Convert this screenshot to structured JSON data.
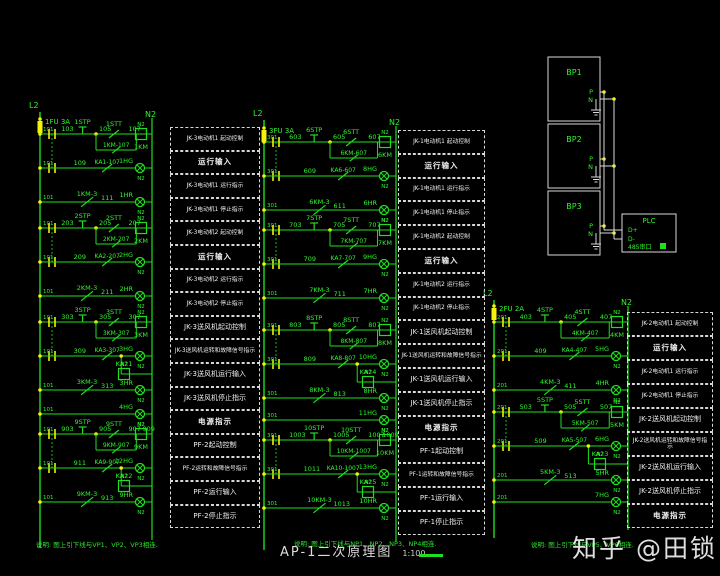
{
  "watermark": {
    "text": "知乎 @田锁"
  },
  "title_block": {
    "title": "AP-1二次原理图",
    "scale": "1:100"
  },
  "notes": {
    "left": "说明: 图上引下线与VP1、VP2、VP3相连.",
    "center": "说明: 图上引下线与NP1、NP2、NP3、NP4相连.",
    "right": "说明: 图上引下线与VP5、VP6相连."
  },
  "colors": {
    "wire": "#1fdf1f",
    "text": "#2ef52e",
    "accent": "#f2f20a",
    "panel": "#d9d9d9"
  },
  "bp_panel": {
    "units": [
      "BP1",
      "BP2",
      "BP3"
    ],
    "terminal_p": "P",
    "terminal_n": "N",
    "plc": {
      "title": "PLC",
      "d_plus": "D+",
      "d_minus": "D-",
      "port": "485串口"
    }
  },
  "columns": [
    {
      "phase": "L2",
      "neutral": "N2",
      "fuse": "1FU 3A",
      "rail_tag": "101",
      "power_lamp": "4HG",
      "sections": [
        {
          "nums": [
            "103",
            "105",
            "107"
          ],
          "stp": "1STP",
          "stt": "1STT",
          "coil": "1KM",
          "seal": "1KM-107",
          "ka_num": "109",
          "ka": "KA1-107",
          "hg": "1HG",
          "run": "1KM-3",
          "run_num": "111",
          "hr": "1HR"
        },
        {
          "nums": [
            "203",
            "205",
            "207"
          ],
          "stp": "2STP",
          "stt": "2STT",
          "coil": "2KM",
          "seal": "2KM-207",
          "ka_num": "209",
          "ka": "KA2-207",
          "hg": "2HG",
          "run": "2KM-3",
          "run_num": "211",
          "hr": "2HR"
        },
        {
          "nums": [
            "303",
            "305",
            "307"
          ],
          "stp": "3STP",
          "stt": "3STT",
          "coil": "3KM",
          "seal": "3KM-307",
          "ka_num": "309",
          "ka": "KA3-307",
          "hg": "3HG",
          "aux": "KA21",
          "run": "3KM-3",
          "run_num": "313",
          "hr": "3HR"
        },
        {
          "nums": [
            "903",
            "905",
            "907"
          ],
          "num4": "909",
          "stp": "9STP",
          "stt": "9STT",
          "coil": "9KM",
          "seal": "9KM-907",
          "ka_num": "911",
          "ka": "KA9-907",
          "hg": "12HG",
          "aux": "KA22",
          "run": "9KM-3",
          "run_num": "913",
          "hr": "9HR"
        }
      ],
      "boxes": [
        "JK-3电动机1 起动控制",
        "运行输入",
        "JK-3电动机1 运行指示",
        "JK-3电动机1 停止指示",
        "JK-3电动机2 起动控制",
        "运行输入",
        "JK-3电动机2 运行指示",
        "JK-3电动机2 停止指示",
        "JK-3送风机起动控制",
        "JK-3送风机运转和故障信号指示",
        "JK-3送风机运行输入",
        "JK-3送风机停止指示",
        "电源指示",
        "PF-2起动控制",
        "PF-2运转和故障信号指示",
        "PF-2运行输入",
        "PF-2停止指示"
      ]
    },
    {
      "phase": "L2",
      "neutral": "N2",
      "fuse": "3FU 3A",
      "rail_tag": "301",
      "power_lamp": "11HG",
      "sections": [
        {
          "nums": [
            "603",
            "605",
            "607"
          ],
          "stp": "6STP",
          "stt": "6STT",
          "coil": "6KM",
          "seal": "6KM-607",
          "ka_num": "609",
          "ka": "KA6-607",
          "hg": "8HG",
          "run": "6KM-3",
          "run_num": "611",
          "hr": "6HR"
        },
        {
          "nums": [
            "703",
            "705",
            "707"
          ],
          "stp": "7STP",
          "stt": "7STT",
          "coil": "7KM",
          "seal": "7KM-707",
          "ka_num": "709",
          "ka": "KA7-707",
          "hg": "9HG",
          "run": "7KM-3",
          "run_num": "711",
          "hr": "7HR"
        },
        {
          "nums": [
            "803",
            "805",
            "807"
          ],
          "stp": "8STP",
          "stt": "8STT",
          "coil": "8KM",
          "seal": "8KM-807",
          "ka_num": "809",
          "ka": "KA8-807",
          "hg": "10HG",
          "aux": "KA24",
          "run": "8KM-3",
          "run_num": "813",
          "hr": "8HR"
        },
        {
          "nums": [
            "1003",
            "1005",
            "1007"
          ],
          "num4": "1009",
          "stp": "10STP",
          "stt": "10STT",
          "coil": "10KM",
          "seal": "10KM-1007",
          "ka_num": "1011",
          "ka": "KA10-1007",
          "hg": "13HG",
          "aux": "KA25",
          "run": "10KM-3",
          "run_num": "1013",
          "hr": "10HR"
        }
      ],
      "boxes": [
        "JK-1电动机1 起动控制",
        "运行输入",
        "JK-1电动机1 运行指示",
        "JK-1电动机1 停止指示",
        "JK-1电动机2 起动控制",
        "运行输入",
        "JK-1电动机2 运行指示",
        "JK-1电动机2 停止指示",
        "JK-1送风机起动控制",
        "JK-1送风机运转和故障信号指示",
        "JK-1送风机运行输入",
        "JK-1送风机停止指示",
        "电源指示",
        "PF-1起动控制",
        "PF-1运转和故障信号指示",
        "PF-1运行输入",
        "PF-1停止指示"
      ]
    },
    {
      "phase": "L2",
      "neutral": "N2",
      "fuse": "2FU 2A",
      "rail_tag": "201",
      "power_lamp": "7HG",
      "sections": [
        {
          "nums": [
            "403",
            "405",
            "407"
          ],
          "stp": "4STP",
          "stt": "4STT",
          "coil": "4KM",
          "seal": "4KM-407",
          "ka_num": "409",
          "ka": "KA4-407",
          "hg": "5HG",
          "run": "4KM-3",
          "run_num": "411",
          "hr": "4HR"
        },
        {
          "nums": [
            "503",
            "505",
            "507"
          ],
          "stp": "5STP",
          "stt": "5STT",
          "coil": "5KM",
          "seal": "5KM-507",
          "ka_num": "509",
          "ka": "KA5-507",
          "hg": "6HG",
          "aux": "KA23",
          "run": "5KM-3",
          "run_num": "513",
          "hr": "5HR"
        }
      ],
      "boxes": [
        "JK-2电动机1 起动控制",
        "运行输入",
        "JK-2电动机1 运行指示",
        "JK-2电动机1 停止指示",
        "JK-2送风机起动控制",
        "JK-2送风机运转和故障信号指示",
        "JK-2送风机运行输入",
        "JK-2送风机停止指示",
        "电源指示"
      ]
    }
  ]
}
